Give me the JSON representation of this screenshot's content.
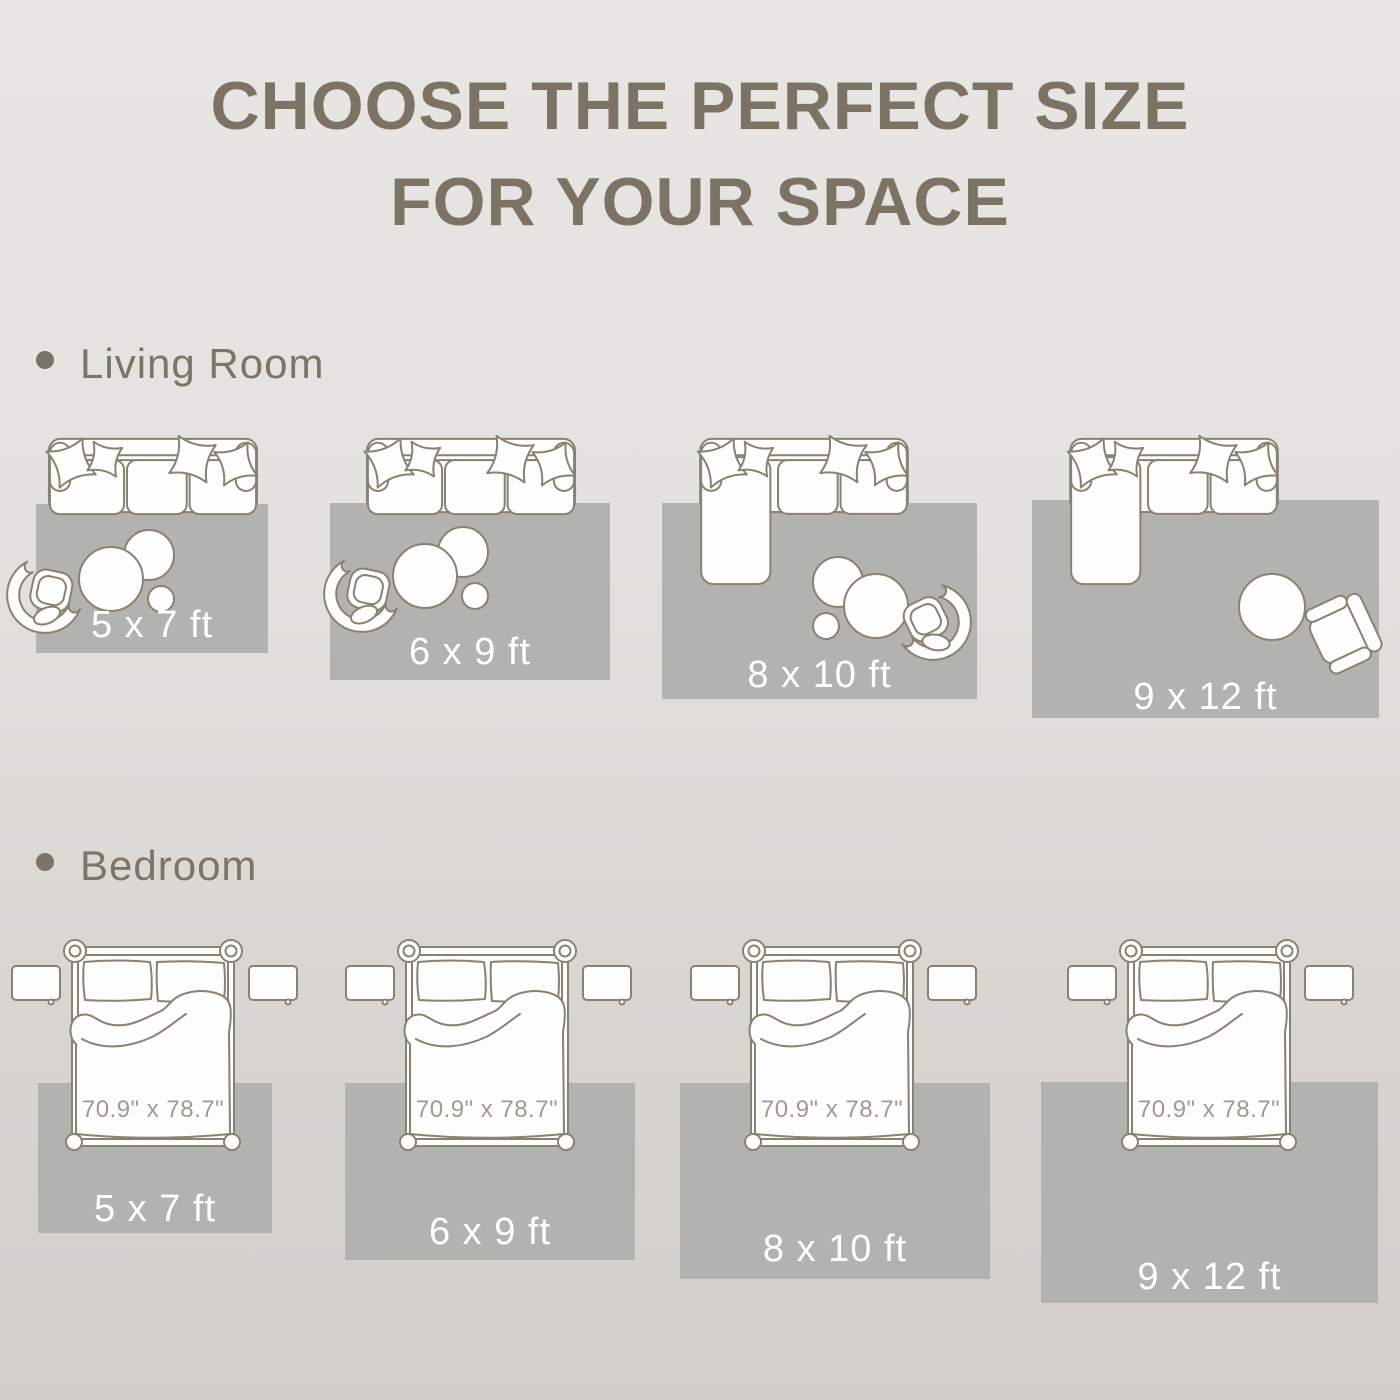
{
  "title": {
    "line1": "CHOOSE THE PERFECT SIZE",
    "line2": "FOR YOUR SPACE"
  },
  "living_room": {
    "label": "Living Room",
    "layouts": [
      {
        "rug_size": "5 x 7 ft"
      },
      {
        "rug_size": "6 x 9 ft"
      },
      {
        "rug_size": "8 x 10 ft"
      },
      {
        "rug_size": "9 x 12 ft"
      }
    ]
  },
  "bedroom": {
    "label": "Bedroom",
    "layouts": [
      {
        "rug_size": "5 x 7 ft",
        "bed_size": "70.9\" x 78.7\""
      },
      {
        "rug_size": "6 x 9 ft",
        "bed_size": "70.9\" x 78.7\""
      },
      {
        "rug_size": "8 x 10 ft",
        "bed_size": "70.9\" x 78.7\""
      },
      {
        "rug_size": "9 x 12 ft",
        "bed_size": "70.9\" x 78.7\""
      }
    ]
  },
  "colors": {
    "background_top": "#e8e6e3",
    "background_bottom": "#d2cfcb",
    "rug": "#b2b3ae",
    "furniture_outline": "#8a8173",
    "furniture_fill": "#fdfdfc",
    "title_text": "#7d7365",
    "section_label_text": "#7c7467",
    "rug_label_text": "#ffffff",
    "bed_label_text": "#a19a90"
  }
}
